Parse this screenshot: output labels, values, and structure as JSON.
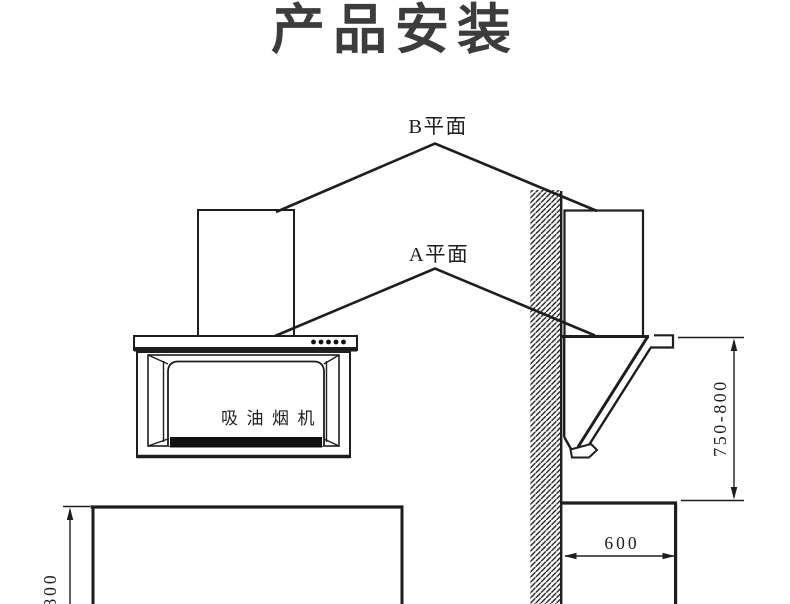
{
  "title": "产品安装",
  "diagram": {
    "labels": {
      "plane_b": "B平面",
      "plane_a": "A平面",
      "hood_name": "吸油烟机"
    },
    "dimensions": {
      "hood_height_above_counter": "750-800",
      "counter_depth": "600",
      "counter_height": "800"
    },
    "colors": {
      "line": "#1e1e1e",
      "background": "#ffffff",
      "title_text": "#3c3c3c",
      "filter_strip": "#111111"
    },
    "icons": {
      "control_buttons": "five-dot-control-buttons",
      "wall": "diagonal-hatch-wall-section"
    }
  }
}
